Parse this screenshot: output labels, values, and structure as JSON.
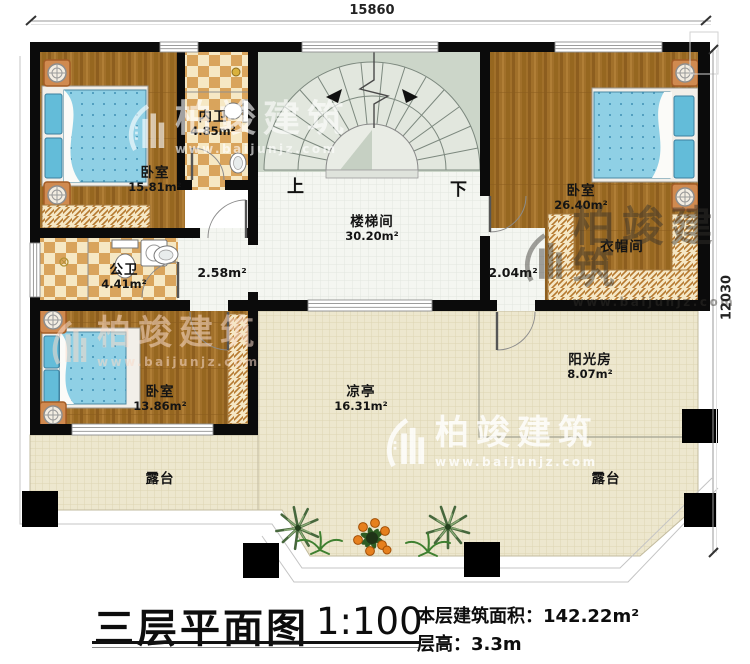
{
  "dimensions": {
    "top": "15860",
    "right": "12030"
  },
  "stairs": {
    "up": "上",
    "down": "下"
  },
  "rooms": {
    "bedroom1": {
      "name": "卧室",
      "area": "15.81m²"
    },
    "inner_bath": {
      "name": "内卫",
      "area": "4.85m²"
    },
    "public_bath": {
      "name": "公卫",
      "area": "4.41m²"
    },
    "stair_hall": {
      "name": "楼梯间",
      "area": "30.20m²"
    },
    "hall_left": {
      "area": "2.58m²"
    },
    "hall_right": {
      "area": "2.04m²"
    },
    "bedroom2": {
      "name": "卧室",
      "area": "26.40m²"
    },
    "cloakroom": {
      "name": "衣帽间"
    },
    "bedroom3": {
      "name": "卧室",
      "area": "13.86m²"
    },
    "pavilion": {
      "name": "凉亭",
      "area": "16.31m²"
    },
    "sunroom": {
      "name": "阳光房",
      "area": "8.07m²"
    },
    "terrace_left": {
      "name": "露台"
    },
    "terrace_right": {
      "name": "露台"
    }
  },
  "title": {
    "main": "三层平面图",
    "scale": "1:100",
    "area_line": "本层建筑面积：142.22m²",
    "height_line": "层高：3.3m"
  },
  "watermark": {
    "brand": "柏竣建筑",
    "url": "www.baijunjz.com"
  },
  "colors": {
    "wall": "#0b0b0b",
    "wood": "#a1702a",
    "tile_dark": "#d9a45c",
    "terrace": "#ede7ce",
    "stair_green": "#ccd6c9",
    "bed_blue": "#8fd0e5"
  }
}
